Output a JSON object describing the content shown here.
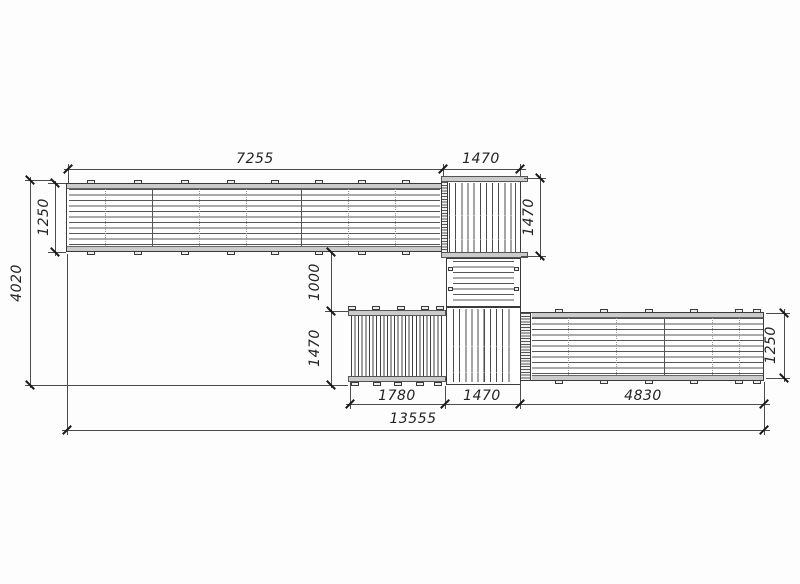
{
  "drawing": {
    "kind": "deck plan view",
    "dims": {
      "top_deck_length": "7255",
      "upper_platform_width": "1470",
      "upper_platform_depth": "1470",
      "top_deck_width": "1250",
      "overall_depth": "4020",
      "opening_depth": "1000",
      "lower_section_depth": "1470",
      "walkway_length": "1780",
      "lower_platform_width": "1470",
      "right_deck_length": "4830",
      "right_deck_width": "1250",
      "overall_length": "13555"
    }
  }
}
